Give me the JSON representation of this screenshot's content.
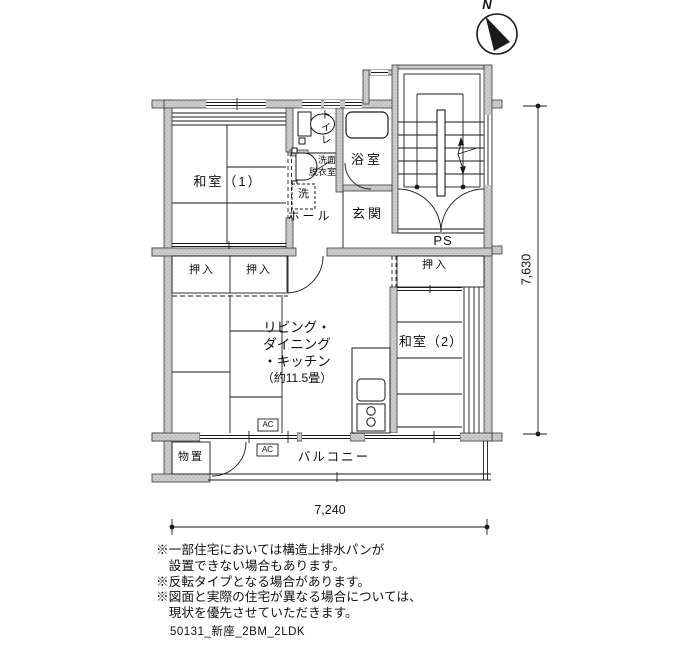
{
  "compass": {
    "label": "N"
  },
  "labels": {
    "washitsu1": "和室（1）",
    "toilet": "トイレ",
    "senmen1": "洗面",
    "senmen2": "脱衣室",
    "laundry": "洗",
    "hall": "ホール",
    "bath": "浴室",
    "genkan": "玄関",
    "ps": "PS",
    "oshiire_a": "押入",
    "oshiire_b": "押入",
    "oshiire_c": "押入",
    "ldk1": "リビング・",
    "ldk2": "ダイニング",
    "ldk3": "・キッチン",
    "ldk4": "（約11.5畳）",
    "washitsu2": "和室（2）",
    "monooki": "物置",
    "balcony": "バルコニー",
    "ac_upper": "AC",
    "ac_lower": "AC"
  },
  "dimensions": {
    "horizontal": "7,240",
    "vertical": "7,630"
  },
  "notes": [
    "※一部住宅においては構造上排水パンが",
    "　設置できない場合もあります。",
    "※反転タイプとなる場合があります。",
    "※図面と実際の住宅が異なる場合については、",
    "　現状を優先させていただきます。"
  ],
  "footer": {
    "file_label": "50131_新座_2BM_2LDK"
  },
  "colors": {
    "wall_fill": "#c8c8c8",
    "line": "#1a1a1a",
    "background": "#ffffff"
  }
}
